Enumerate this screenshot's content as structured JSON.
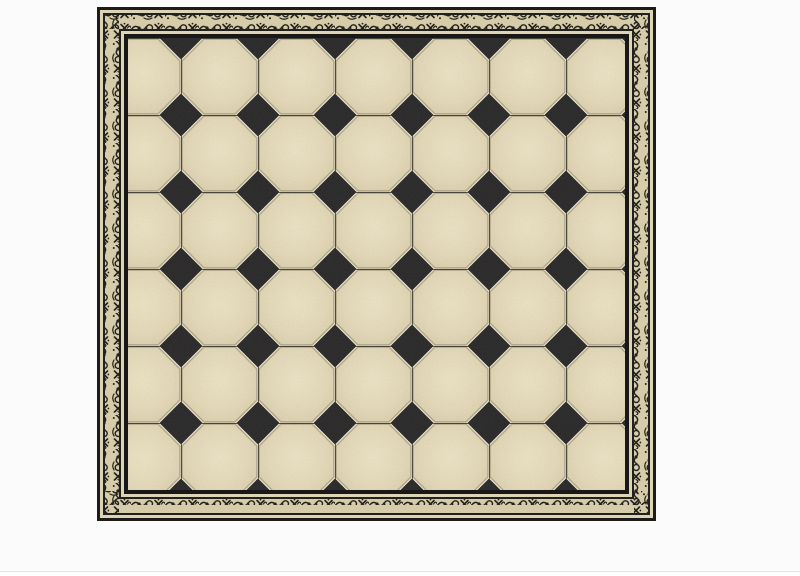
{
  "page": {
    "aria_title": "Octagon and dot tile floor panel with ornate engraved border frame on white background"
  },
  "colors": {
    "page_bg": "#fbfbfb",
    "divider": "#e4e4e4",
    "footer_bg": "#fdfdfd",
    "frame_black": "#1d1c19",
    "frame_cream": "#ddd3b5",
    "frame_black2": "#22211d",
    "ornate_bg": "#d6cca9",
    "ink": "#23221d",
    "frame_black3": "#191816",
    "grout": "#f3ebd3",
    "tile_hi": "#ece2c6",
    "tile_mid": "#e4daba",
    "tile_lo": "#d8cdac",
    "oct_edge": "rgba(92,80,52,0.38)",
    "joint": "#1f1e1a",
    "tile_dark": "#2a292a"
  },
  "artwork": {
    "left": 97,
    "top": 7,
    "width": 559,
    "height": 514,
    "tile_period_px": 77,
    "diamond_half_diagonal_px": 21.5,
    "octagon_columns": 7,
    "octagon_rows": 6,
    "frame_band_widths_px": [
      3,
      3,
      2,
      14,
      2,
      3,
      4
    ]
  }
}
